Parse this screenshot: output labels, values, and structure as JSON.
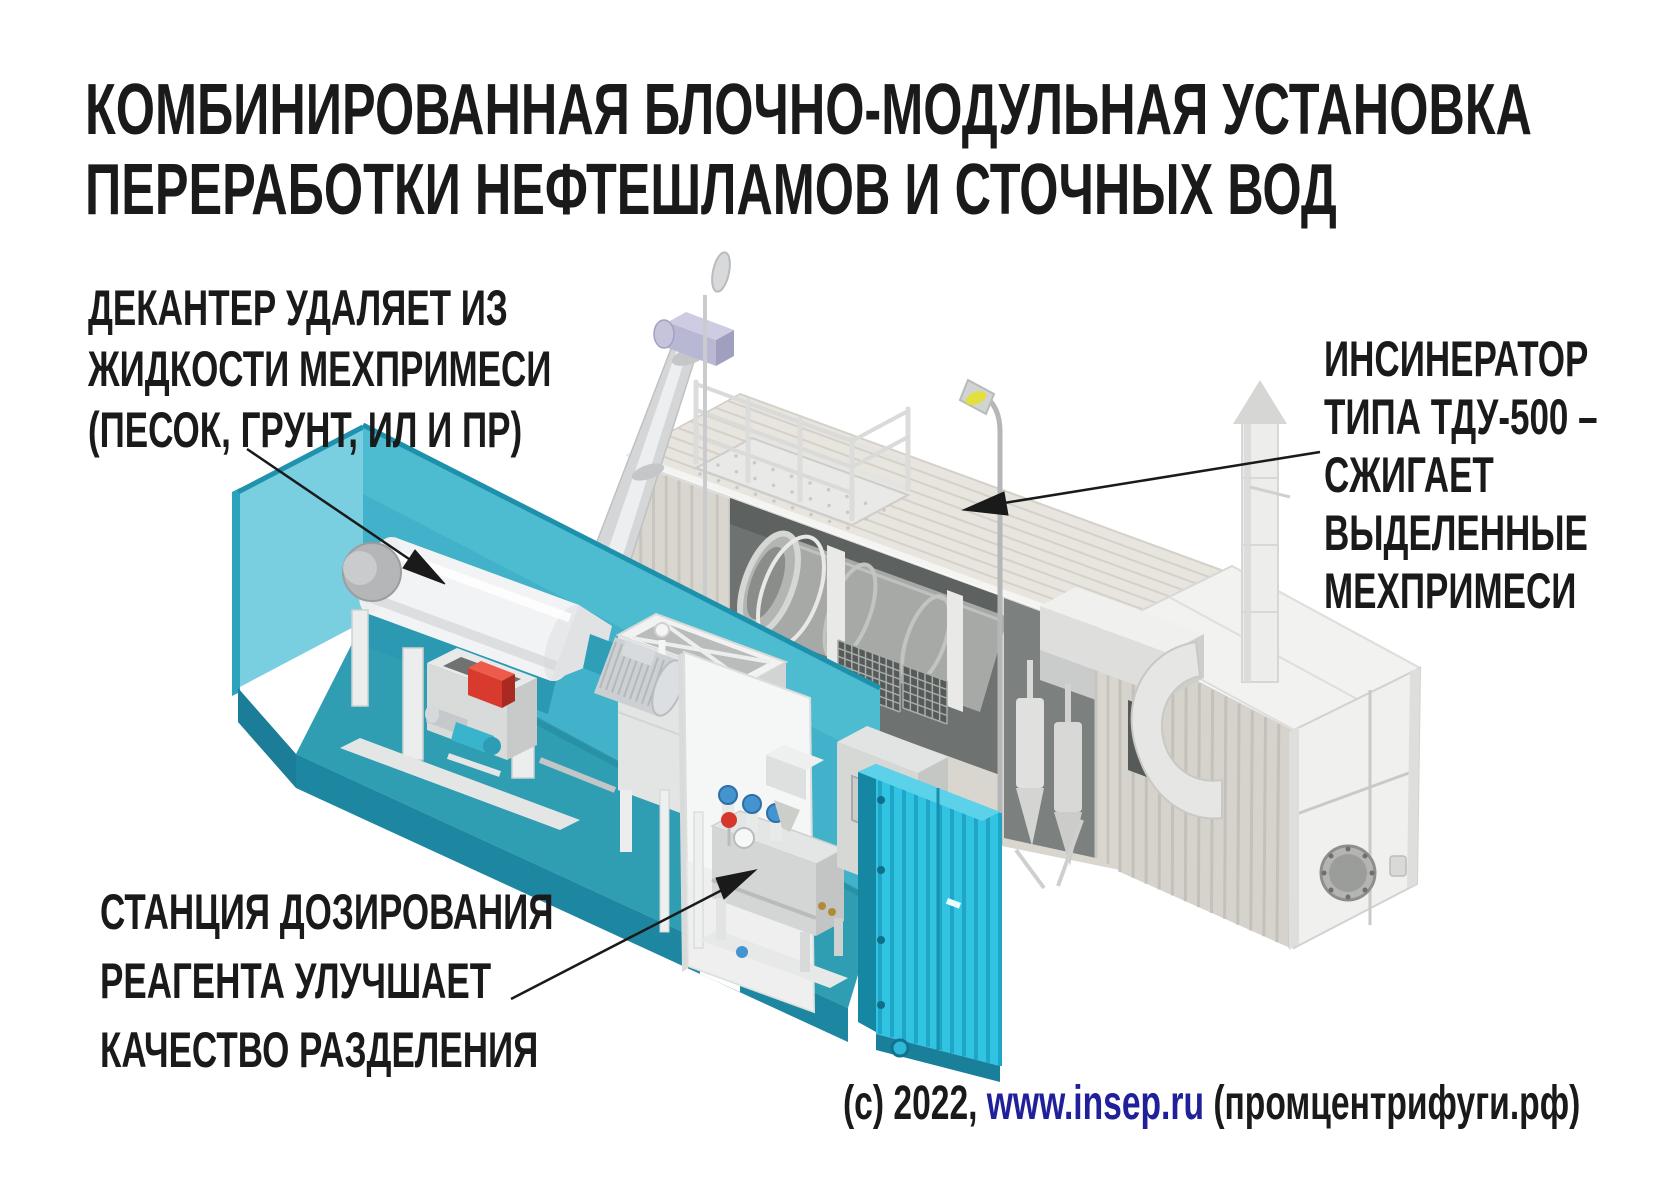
{
  "title": {
    "line1": "КОМБИНИРОВАННАЯ БЛОЧНО-МОДУЛЬНАЯ УСТАНОВКА",
    "line2": "ПЕРЕРАБОТКИ НЕФТЕШЛАМОВ И СТОЧНЫХ ВОД"
  },
  "annotations": {
    "decanter": {
      "lines": [
        "ДЕКАНТЕР УДАЛЯЕТ ИЗ",
        "ЖИДКОСТИ МЕХПРИМЕСИ",
        "(ПЕСОК, ГРУНТ, ИЛ И ПР)"
      ]
    },
    "incinerator": {
      "lines": [
        "ИНСИНЕРАТОР",
        "ТИПА ТДУ-500 –",
        "СЖИГАЕТ",
        "ВЫДЕЛЕННЫЕ",
        "МЕХПРИМЕСИ"
      ]
    },
    "dosing": {
      "lines": [
        "СТАНЦИЯ ДОЗИРОВАНИЯ",
        "РЕАГЕНТА УЛУЧШАЕТ",
        "КАЧЕСТВО РАЗДЕЛЕНИЯ"
      ]
    }
  },
  "credit": {
    "prefix": "(c) 2022, ",
    "link": "www.insep.ru",
    "suffix": " (промцентрифуги.рф)"
  },
  "colors": {
    "text": "#1a1a1a",
    "link_blue": "#20209a",
    "teal_container": "#35c3e1",
    "teal_wall": "#41b2ca",
    "white_container": "#d8d6ce",
    "alert_red": "#d93a2e",
    "lamp_yellow": "#e3df3e"
  }
}
